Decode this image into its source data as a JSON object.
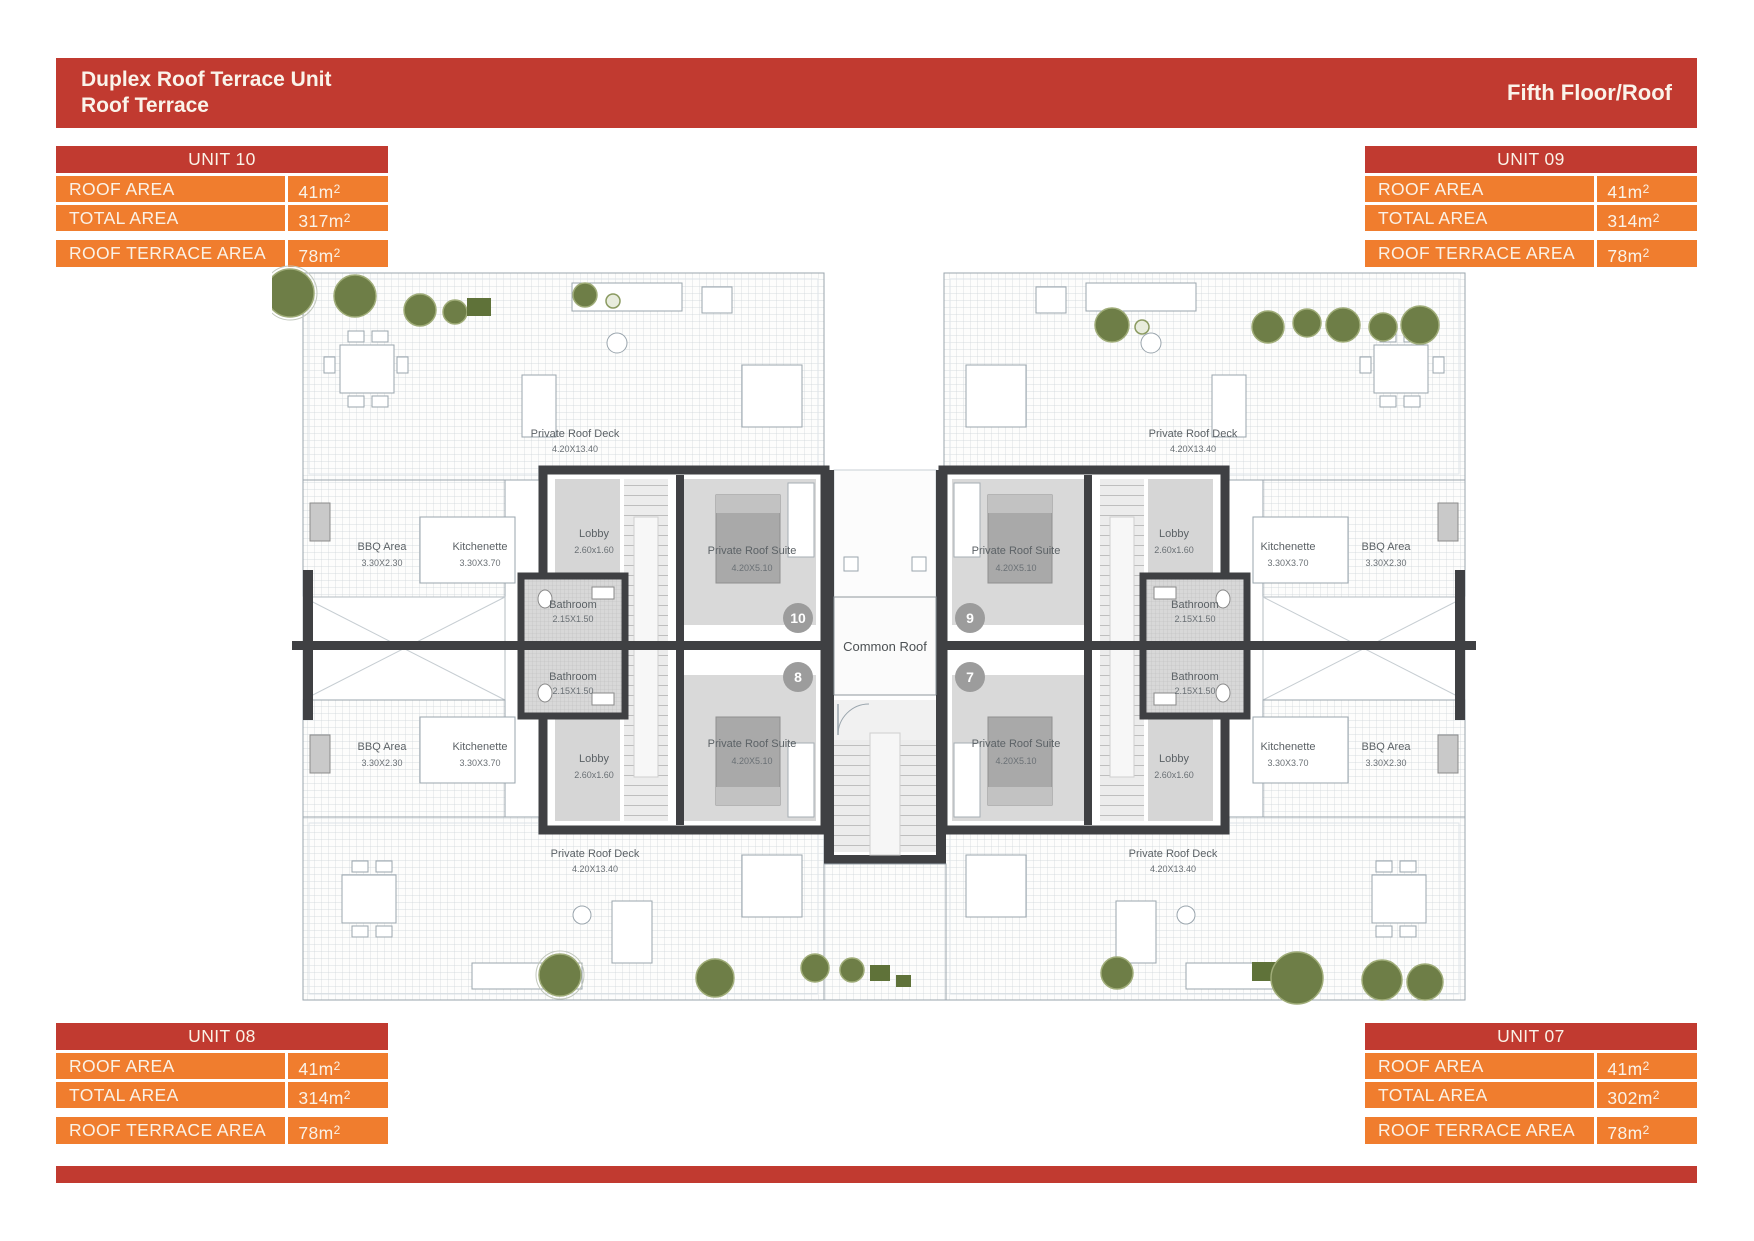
{
  "header": {
    "title_line1": "Duplex Roof Terrace Unit",
    "title_line2": "Roof Terrace",
    "floor": "Fifth Floor/Roof"
  },
  "tables": {
    "unit10": {
      "title": "UNIT 10",
      "rows": [
        {
          "label": "ROOF AREA",
          "value": "41m",
          "sup": "2"
        },
        {
          "label": "TOTAL AREA",
          "value": "317m",
          "sup": "2"
        }
      ],
      "terrace": {
        "label": "ROOF TERRACE AREA",
        "value": "78m",
        "sup": "2"
      }
    },
    "unit09": {
      "title": "UNIT 09",
      "rows": [
        {
          "label": "ROOF AREA",
          "value": "41m",
          "sup": "2"
        },
        {
          "label": "TOTAL AREA",
          "value": "314m",
          "sup": "2"
        }
      ],
      "terrace": {
        "label": "ROOF TERRACE AREA",
        "value": "78m",
        "sup": "2"
      }
    },
    "unit08": {
      "title": "UNIT 08",
      "rows": [
        {
          "label": "ROOF AREA",
          "value": "41m",
          "sup": "2"
        },
        {
          "label": "TOTAL AREA",
          "value": "314m",
          "sup": "2"
        }
      ],
      "terrace": {
        "label": "ROOF TERRACE AREA",
        "value": "78m",
        "sup": "2"
      }
    },
    "unit07": {
      "title": "UNIT 07",
      "rows": [
        {
          "label": "ROOF AREA",
          "value": "41m",
          "sup": "2"
        },
        {
          "label": "TOTAL AREA",
          "value": "302m",
          "sup": "2"
        }
      ],
      "terrace": {
        "label": "ROOF TERRACE AREA",
        "value": "78m",
        "sup": "2"
      }
    }
  },
  "plan": {
    "rooms": {
      "deck": {
        "name": "Private Roof Deck",
        "dims": "4.20X13.40"
      },
      "bbq": {
        "name": "BBQ Area",
        "dims": "3.30X2.30"
      },
      "kitchenette": {
        "name": "Kitchenette",
        "dims": "3.30X3.70"
      },
      "lobby": {
        "name": "Lobby",
        "dims": "2.60x1.60"
      },
      "suite": {
        "name": "Private Roof Suite",
        "dims": "4.20X5.10"
      },
      "bathroom": {
        "name": "Bathroom",
        "dims": "2.15X1.50"
      },
      "common": {
        "name": "Common Roof"
      }
    },
    "markers": {
      "m10": "10",
      "m9": "9",
      "m8": "8",
      "m7": "7"
    }
  },
  "colors": {
    "red": "#c13a30",
    "orange": "#f07d2e",
    "text_on_color": "#faf2e7",
    "wall": "#3f4043",
    "room_gray": "#d6d6d6",
    "tree_green": "#6e7e47",
    "shrub_green": "#5f7239",
    "marker_gray": "#9c9c9c"
  }
}
